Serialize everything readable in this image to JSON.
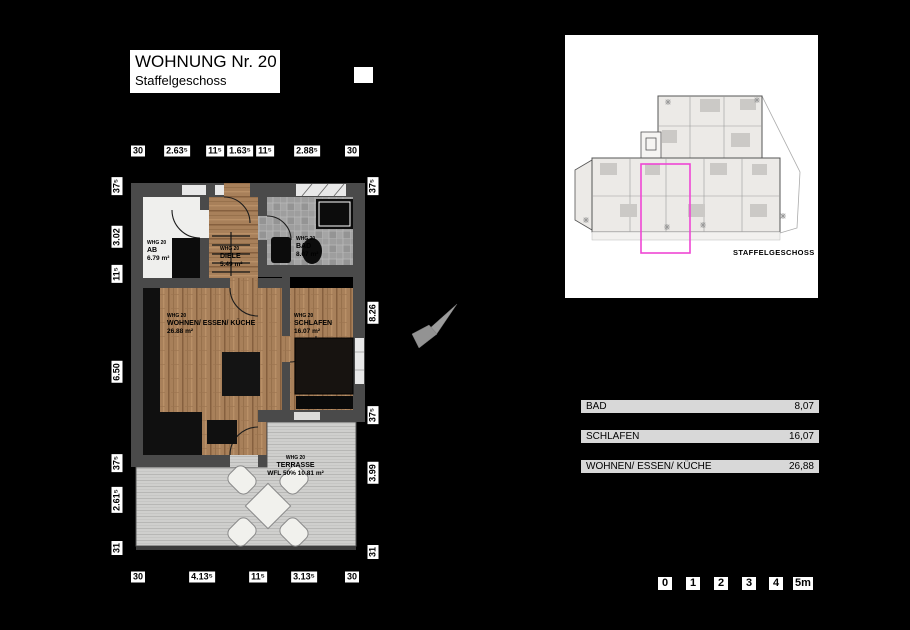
{
  "title_block": {
    "title": "WOHNUNG Nr. 20",
    "subtitle": "Staffelgeschoss"
  },
  "plan": {
    "rooms": {
      "ab": {
        "whg": "WHG 20",
        "name": "AB",
        "area": "6.79 m²"
      },
      "diele": {
        "whg": "WHG 20",
        "name": "DIELE",
        "area": "5.49 m²"
      },
      "bad": {
        "whg": "WHG 20",
        "name": "BAD",
        "area": "8.07 m²"
      },
      "wohnen": {
        "whg": "WHG 20",
        "name": "WOHNEN/ ESSEN/ KÜCHE",
        "area": "26.88 m²"
      },
      "schlafen": {
        "whg": "WHG 20",
        "name": "SCHLAFEN",
        "area": "16.07 m²"
      },
      "terrasse": {
        "whg": "WHG 20",
        "name": "TERRASSE",
        "area": "WFL 50% 10.81 m²"
      }
    },
    "dims": {
      "top": [
        "30",
        "2.63⁵",
        "11⁵",
        "1.63⁵",
        "11⁵",
        "2.88⁵",
        "30"
      ],
      "bottom": [
        "30",
        "4.13⁵",
        "11⁵",
        "3.13⁵",
        "30"
      ],
      "left": [
        "37⁵",
        "3.02",
        "11⁵",
        "6.50",
        "37⁵",
        "2.61⁵",
        "31"
      ],
      "right": [
        "37⁵",
        "8.26",
        "37⁵",
        "3.99",
        "31"
      ]
    }
  },
  "overview": {
    "caption": "STAFFELGESCHOSS",
    "highlight_color": "#ee46d4"
  },
  "area_table": [
    {
      "label": "BAD",
      "value": "8,07"
    },
    {
      "label": "SCHLAFEN",
      "value": "16,07"
    },
    {
      "label": "WOHNEN/ ESSEN/ KÜCHE",
      "value": "26,88"
    }
  ],
  "scale_bar": [
    "0",
    "1",
    "2",
    "3",
    "4",
    "5m"
  ],
  "colors": {
    "background": "#000000",
    "wall": "#4a4a4a",
    "wood": "#a8805a",
    "tile": "#9e9e9e",
    "deck": "#cfcfcd",
    "highlight": "#ee46d4"
  }
}
